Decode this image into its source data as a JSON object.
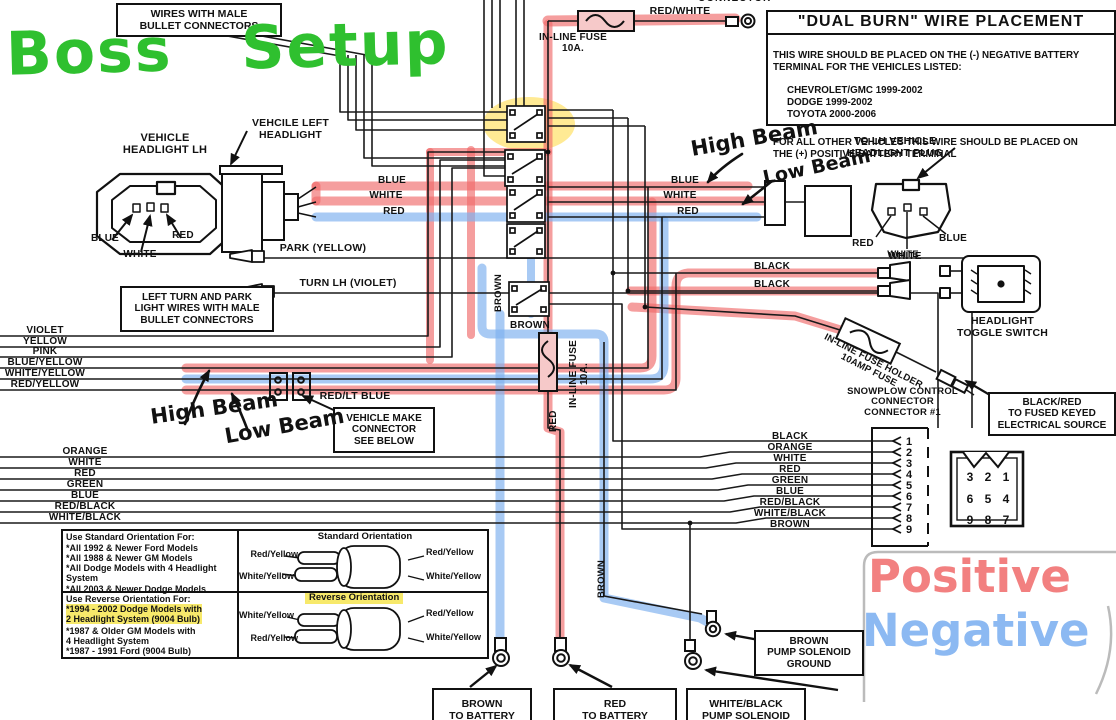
{
  "colors": {
    "highlight_red": "#f07070",
    "highlight_blue": "#83b3f0",
    "highlight_yellow": "#ffd83d",
    "marker_green": "#2fc02f",
    "hand_red": "#f28080",
    "hand_blue": "#8cb9f2"
  },
  "handwriting": {
    "title": "Boss Setup",
    "high_beam_top": "High Beam",
    "low_beam_top": "Low Beam",
    "high_beam_left": "High Beam",
    "low_beam_left": "Low Beam",
    "positive": "Positive",
    "negative": "Negative"
  },
  "top": {
    "wires_male_bullet": "WIRES WITH MALE\nBULLET CONNECTORS",
    "inline_fuse": "IN-LINE FUSE",
    "inline_fuse_amps": "10A.",
    "red_white": "RED/WHITE",
    "connector_partial": "CONNECTOR"
  },
  "dual_burn": {
    "title": "\"DUAL BURN\" WIRE PLACEMENT",
    "intro": "THIS WIRE SHOULD BE PLACED ON THE (-) NEGATIVE BATTERY\nTERMINAL FOR THE VEHICLES LISTED:",
    "vehicles": "CHEVROLET/GMC 1999-2002\nDODGE 1999-2002\nTOYOTA 2000-2006",
    "outro": "FOR ALL OTHER VEHICLES THIS WIRE SHOULD BE PLACED ON\nTHE (+) POSITIVE BATTERY TERMINAL"
  },
  "left_headlight": {
    "title": "VEHICLE\nHEADLIGHT LH",
    "pin_blue": "BLUE",
    "pin_white": "WHITE",
    "pin_red": "RED"
  },
  "vehicle_left_headlight": "VEHCILE LEFT\nHEADLIGHT",
  "bundle_left": {
    "blue": "BLUE",
    "white": "WHITE",
    "red": "RED"
  },
  "bundle_right": {
    "blue": "BLUE",
    "white": "WHITE",
    "red": "RED"
  },
  "right_plug": {
    "title": "TO LH VEHICLE\nHEADLIGHT PLUG",
    "pin_red": "RED",
    "pin_white": "WHITE",
    "pin_blue": "BLUE"
  },
  "park_turn": {
    "park": "PARK (YELLOW)",
    "turn": "TURN LH (VIOLET)",
    "note": "LEFT TURN AND PARK\nLIGHT WIRES WITH MALE\nBULLET CONNECTORS"
  },
  "wire_group1": [
    "VIOLET",
    "YELLOW",
    "PINK",
    "BLUE/YELLOW",
    "WHITE/YELLOW",
    "RED/YELLOW"
  ],
  "red_lt_blue": "RED/LT BLUE",
  "vehicle_make_connector": "VEHICLE MAKE\nCONNECTOR\nSEE BELOW",
  "wire_group2": [
    "ORANGE",
    "WHITE",
    "RED",
    "GREEN",
    "BLUE",
    "RED/BLACK",
    "WHITE/BLACK"
  ],
  "toggle": {
    "black1": "BLACK",
    "black2": "BLACK",
    "white": "WHITE",
    "label": "HEADLIGHT\nTOGGLE SWITCH"
  },
  "fuse_holder": "IN-LINE FUSE HOLDER\n10AMP FUSE",
  "fused_source": "BLACK/RED\nTO FUSED KEYED\nELECTRICAL SOURCE",
  "snowplow": {
    "title": "SNOWPLOW CONTROL\nCONNECTOR\nCONNECTOR #1",
    "pins": [
      "1",
      "2",
      "3",
      "4",
      "5",
      "6",
      "7",
      "8",
      "9"
    ],
    "pin_labels": [
      "BLACK",
      "ORANGE",
      "WHITE",
      "RED",
      "GREEN",
      "BLUE",
      "RED/BLACK",
      "WHITE/BLACK",
      "BROWN"
    ],
    "grid": [
      "3",
      "2",
      "1",
      "6",
      "5",
      "4",
      "9",
      "8",
      "7"
    ]
  },
  "mid": {
    "brown_v1": "BROWN",
    "brown_h": "BROWN",
    "inline_fuse_v": "IN-LINE FUSE\n10A.",
    "red_v": "RED",
    "brown_v2": "BROWN"
  },
  "orientation": {
    "standard_header": "Use Standard Orientation For:",
    "standard_items": "*All 1992 & Newer Ford Models\n*All 1988 & Newer GM Models\n*All Dodge Models with 4 Headlight\n  System\n*All 2003 & Newer Dodge Models",
    "reverse_header": "Use Reverse Orientation For:",
    "reverse_highlight": "*1994 - 2002 Dodge Models with\n  2 Headlight System (9004 Bulb)",
    "reverse_items": "*1987 & Older GM Models with\n  4 Headlight System\n*1987 - 1991 Ford (9004 Bulb)",
    "standard_title": "Standard Orientation",
    "reverse_title": "Reverse Orientation",
    "std_left_top": "Red/Yellow",
    "std_left_bottom": "White/Yellow",
    "std_right_top": "Red/Yellow",
    "std_right_bottom": "White/Yellow",
    "rev_left_top": "White/Yellow",
    "rev_left_bottom": "Red/Yellow",
    "rev_right_top": "Red/Yellow",
    "rev_right_bottom": "White/Yellow"
  },
  "bottom": {
    "brown_battery": "BROWN\nTO BATTERY",
    "red_battery": "RED\nTO BATTERY",
    "white_black_solenoid": "WHITE/BLACK\nPUMP SOLENOID",
    "brown_ground": "BROWN\nPUMP SOLENOID\nGROUND"
  }
}
